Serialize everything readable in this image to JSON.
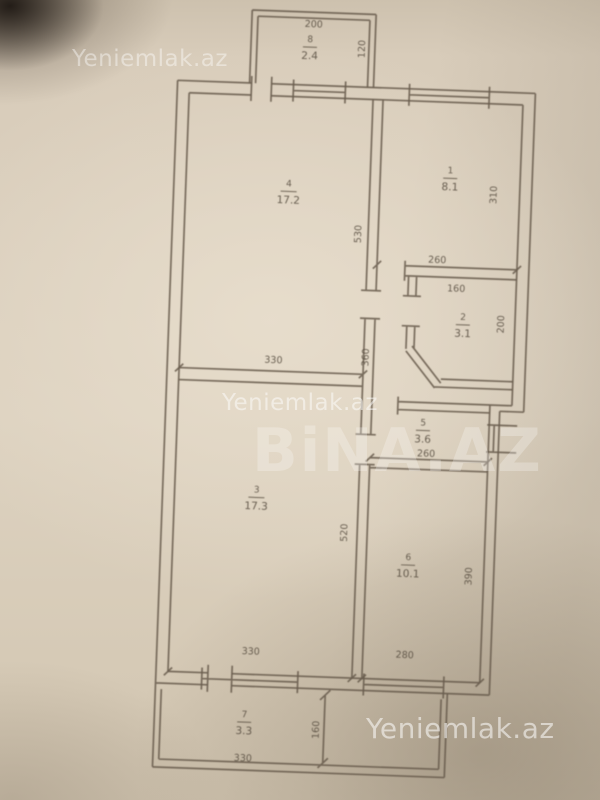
{
  "photo": {
    "watermark_top_left": "Yeniemlak.az",
    "watermark_middle": "Yeniemlak.az",
    "watermark_center_logo": "BiNA.AZ",
    "watermark_bottom_right": "Yeniemlak.az"
  },
  "plan": {
    "rooms": {
      "balcony_top": {
        "number": "8",
        "area": "2.4"
      },
      "room1": {
        "number": "1",
        "area": "8.1"
      },
      "room2": {
        "number": "2",
        "area": "3.1"
      },
      "room3": {
        "number": "3",
        "area": "17.3"
      },
      "room4": {
        "number": "4",
        "area": "17.2"
      },
      "room5": {
        "number": "5",
        "area": "3.6"
      },
      "room6": {
        "number": "6",
        "area": "10.1"
      },
      "balcony_bottom": {
        "number": "7",
        "area": "3.3"
      }
    },
    "dimensions": {
      "balcony_top_width": "200",
      "balcony_top_depth": "120",
      "room4_width": "330",
      "room4_height": "530",
      "room1_width": "260",
      "room1_height": "310",
      "room2_width": "160",
      "room2_height": "200",
      "hall_height": "360",
      "room5_width": "260",
      "room3_width": "330",
      "room3_height": "520",
      "room6_width": "280",
      "room6_height": "390",
      "balcony_bottom_width": "330",
      "balcony_bottom_depth": "160"
    },
    "colors": {
      "paper": "#ddd2c0",
      "ink": "#6a5d4e",
      "watermark": "#ffffff"
    }
  }
}
